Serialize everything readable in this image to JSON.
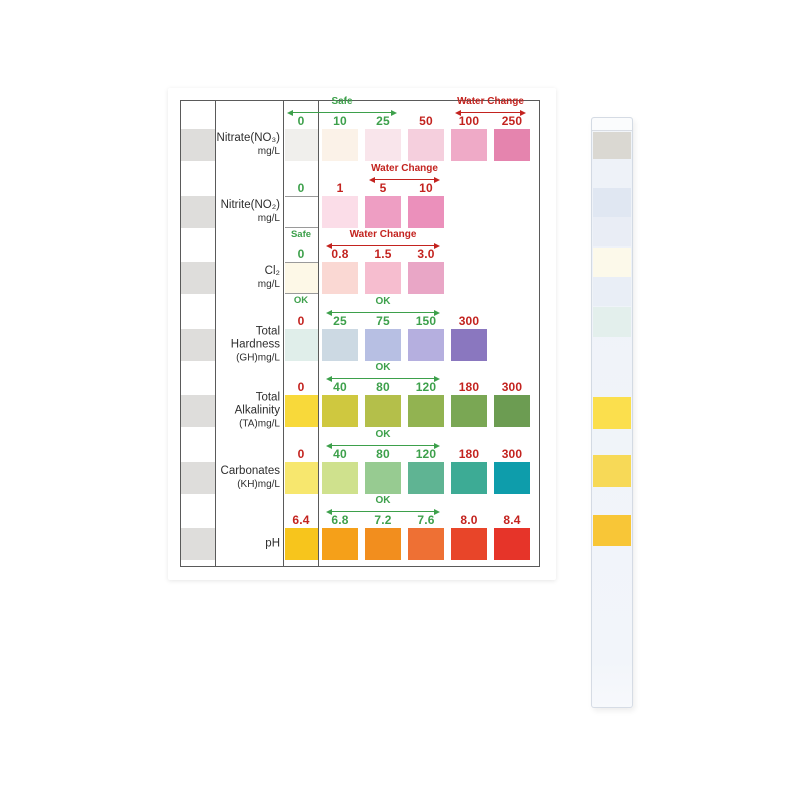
{
  "product": {
    "description": "Aquarium water test strip color chart with reference test strip",
    "background": "#ffffff"
  },
  "colors": {
    "green": "#3da04b",
    "red": "#c3231f",
    "table_border": "#5a5a5a",
    "label_text": "#2e2e2e",
    "left_pad": "#dedddb"
  },
  "chart": {
    "rows": [
      {
        "name": "nitrate",
        "label_lines": [
          "Nitrate(NO₃)",
          "mg/L"
        ],
        "zero": {
          "label": "0",
          "label_color": "green",
          "pad_color": "#f0efec",
          "pad_border": false,
          "note": null
        },
        "arrows": [
          {
            "text": "Safe",
            "color": "green",
            "from": 0,
            "to": 2
          },
          {
            "text": "Water Change",
            "color": "red",
            "from": 4,
            "to": 5
          }
        ],
        "pads": [
          {
            "label": "10",
            "label_color": "green",
            "color": "#fbf2e8"
          },
          {
            "label": "25",
            "label_color": "green",
            "color": "#f9e5eb"
          },
          {
            "label": "50",
            "label_color": "red",
            "color": "#f5cfdd"
          },
          {
            "label": "100",
            "label_color": "red",
            "color": "#efaac7"
          },
          {
            "label": "250",
            "label_color": "red",
            "color": "#e584ae"
          }
        ]
      },
      {
        "name": "nitrite",
        "label_lines": [
          "Nitrite(NO₂)",
          "mg/L"
        ],
        "zero": {
          "label": "0",
          "label_color": "green",
          "pad_color": "#ffffff",
          "pad_border": true,
          "note": "Safe",
          "note_color": "green"
        },
        "arrows": [
          {
            "text": "Water Change",
            "color": "red",
            "from": 2,
            "to": 3
          }
        ],
        "pads": [
          {
            "label": "1",
            "label_color": "red",
            "color": "#fbdde8"
          },
          {
            "label": "5",
            "label_color": "red",
            "color": "#ee9ec3"
          },
          {
            "label": "10",
            "label_color": "red",
            "color": "#eb90bb"
          }
        ]
      },
      {
        "name": "chlorine",
        "label_lines": [
          "Cl₂",
          "mg/L"
        ],
        "zero": {
          "label": "0",
          "label_color": "green",
          "pad_color": "#fdf8e7",
          "pad_border": true,
          "note": "OK",
          "note_color": "green"
        },
        "arrows": [
          {
            "text": "Water Change",
            "color": "red",
            "from": 1,
            "to": 3
          }
        ],
        "pads": [
          {
            "label": "0.8",
            "label_color": "red",
            "color": "#fad8d3"
          },
          {
            "label": "1.5",
            "label_color": "red",
            "color": "#f6bdcf"
          },
          {
            "label": "3.0",
            "label_color": "red",
            "color": "#e9a6c6"
          }
        ]
      },
      {
        "name": "total-hardness",
        "label_lines": [
          "Total",
          "Hardness",
          "(GH)mg/L"
        ],
        "zero": {
          "label": "0",
          "label_color": "red",
          "pad_color": "#e0eeea",
          "pad_border": false,
          "note": null
        },
        "arrows": [
          {
            "text": "OK",
            "color": "green",
            "from": 1,
            "to": 3
          }
        ],
        "pads": [
          {
            "label": "25",
            "label_color": "green",
            "color": "#ccd9e3"
          },
          {
            "label": "75",
            "label_color": "green",
            "color": "#b7bfe3"
          },
          {
            "label": "150",
            "label_color": "green",
            "color": "#b5afdf"
          },
          {
            "label": "300",
            "label_color": "red",
            "color": "#8a77bf"
          }
        ]
      },
      {
        "name": "total-alkalinity",
        "label_lines": [
          "Total",
          "Alkalinity",
          "(TA)mg/L"
        ],
        "zero": {
          "label": "0",
          "label_color": "red",
          "pad_color": "#f8d93a",
          "pad_border": false,
          "note": null
        },
        "arrows": [
          {
            "text": "OK",
            "color": "green",
            "from": 1,
            "to": 3
          }
        ],
        "pads": [
          {
            "label": "40",
            "label_color": "green",
            "color": "#cfc83f"
          },
          {
            "label": "80",
            "label_color": "green",
            "color": "#b4bf4a"
          },
          {
            "label": "120",
            "label_color": "green",
            "color": "#92b351"
          },
          {
            "label": "180",
            "label_color": "red",
            "color": "#7aa754"
          },
          {
            "label": "300",
            "label_color": "red",
            "color": "#6c9c52"
          }
        ]
      },
      {
        "name": "carbonates",
        "label_lines": [
          "Carbonates",
          "(KH)mg/L"
        ],
        "zero": {
          "label": "0",
          "label_color": "red",
          "pad_color": "#f7e76e",
          "pad_border": false,
          "note": null
        },
        "arrows": [
          {
            "text": "OK",
            "color": "green",
            "from": 1,
            "to": 3
          }
        ],
        "pads": [
          {
            "label": "40",
            "label_color": "green",
            "color": "#cfe18d"
          },
          {
            "label": "80",
            "label_color": "green",
            "color": "#97cb91"
          },
          {
            "label": "120",
            "label_color": "green",
            "color": "#5fb493"
          },
          {
            "label": "180",
            "label_color": "red",
            "color": "#3dab95"
          },
          {
            "label": "300",
            "label_color": "red",
            "color": "#0e9dab"
          }
        ]
      },
      {
        "name": "ph",
        "label_lines": [
          "pH"
        ],
        "zero": {
          "label": "6.4",
          "label_color": "red",
          "pad_color": "#f7c51c",
          "pad_border": false,
          "note": null
        },
        "arrows": [
          {
            "text": "OK",
            "color": "green",
            "from": 1,
            "to": 3
          }
        ],
        "pads": [
          {
            "label": "6.8",
            "label_color": "green",
            "color": "#f5a019"
          },
          {
            "label": "7.2",
            "label_color": "green",
            "color": "#f28e1e"
          },
          {
            "label": "7.6",
            "label_color": "green",
            "color": "#ee7034"
          },
          {
            "label": "8.0",
            "label_color": "red",
            "color": "#e84529"
          },
          {
            "label": "8.4",
            "label_color": "red",
            "color": "#e63429"
          }
        ]
      }
    ]
  },
  "strip": {
    "pads": [
      {
        "name": "nitrate-pad",
        "color": "#dad8d2"
      },
      {
        "name": "nitrite-pad",
        "color": "#e0e7f2"
      },
      {
        "name": "blank-pad-1",
        "color": "#e9edf5"
      },
      {
        "name": "cl2-pad",
        "color": "#fcf9ea"
      },
      {
        "name": "blank-pad-2",
        "color": "#e9eef6"
      },
      {
        "name": "hardness-pad",
        "color": "#e3efec"
      },
      {
        "name": "alkalinity-pad",
        "color": "#fbdf4d"
      },
      {
        "name": "carbonates-pad",
        "color": "#f7d957"
      },
      {
        "name": "ph-pad",
        "color": "#f8c637"
      }
    ]
  },
  "chart_data": {
    "type": "table",
    "title": "Water test strip color chart",
    "rows": [
      {
        "parameter": "Nitrate(NO3) mg/L",
        "values": [
          "0",
          "10",
          "25",
          "50",
          "100",
          "250"
        ],
        "safe_range": "0-25 Safe",
        "action_range": "100-250 Water Change"
      },
      {
        "parameter": "Nitrite(NO2) mg/L",
        "values": [
          "0",
          "1",
          "5",
          "10"
        ],
        "safe_range": "0 Safe",
        "action_range": "5-10 Water Change"
      },
      {
        "parameter": "Cl2 mg/L",
        "values": [
          "0",
          "0.8",
          "1.5",
          "3.0"
        ],
        "safe_range": "0 OK",
        "action_range": "0.8-3.0 Water Change"
      },
      {
        "parameter": "Total Hardness (GH) mg/L",
        "values": [
          "0",
          "25",
          "75",
          "150",
          "300"
        ],
        "safe_range": "25-150 OK",
        "action_range": ""
      },
      {
        "parameter": "Total Alkalinity (TA) mg/L",
        "values": [
          "0",
          "40",
          "80",
          "120",
          "180",
          "300"
        ],
        "safe_range": "40-120 OK",
        "action_range": ""
      },
      {
        "parameter": "Carbonates (KH) mg/L",
        "values": [
          "0",
          "40",
          "80",
          "120",
          "180",
          "300"
        ],
        "safe_range": "40-120 OK",
        "action_range": ""
      },
      {
        "parameter": "pH",
        "values": [
          "6.4",
          "6.8",
          "7.2",
          "7.6",
          "8.0",
          "8.4"
        ],
        "safe_range": "6.8-7.6 OK",
        "action_range": ""
      }
    ]
  }
}
